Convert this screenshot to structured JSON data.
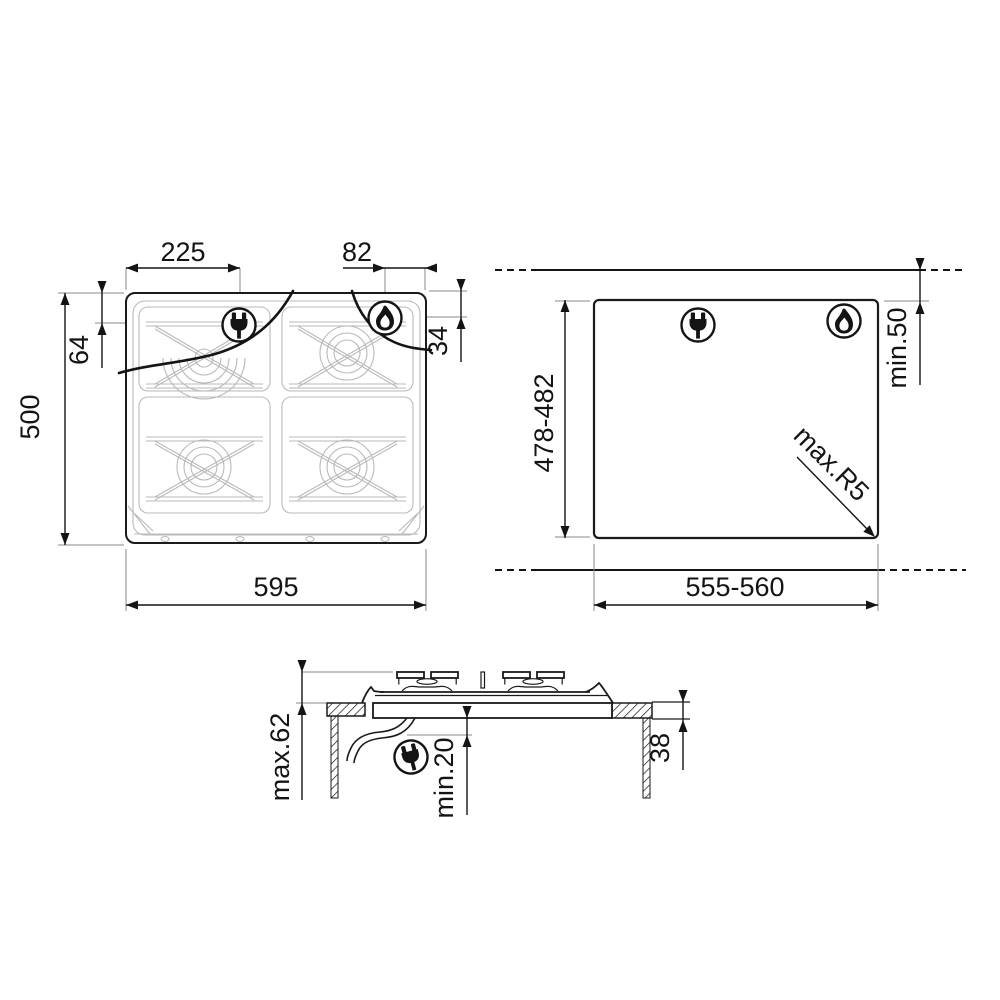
{
  "drawing": {
    "type": "hob-installation-dimensions",
    "colors": {
      "line": "#141414",
      "secondary": "#b9b9b9",
      "extension": "#8a8a8a",
      "background": "#ffffff"
    },
    "top_view": {
      "dims": {
        "plug_offset_x": "225",
        "flame_offset_x": "82",
        "plug_offset_y": "64",
        "flame_offset_y": "34",
        "depth": "500",
        "width": "595"
      }
    },
    "cutout_view": {
      "dims": {
        "depth": "478-482",
        "width": "555-560",
        "rear_clearance": "min.50",
        "corner_radius": "max.R5"
      }
    },
    "side_view": {
      "dims": {
        "height_above_worktop": "max.62",
        "clearance_below": "min.20",
        "depth_below_worktop": "38"
      }
    }
  }
}
